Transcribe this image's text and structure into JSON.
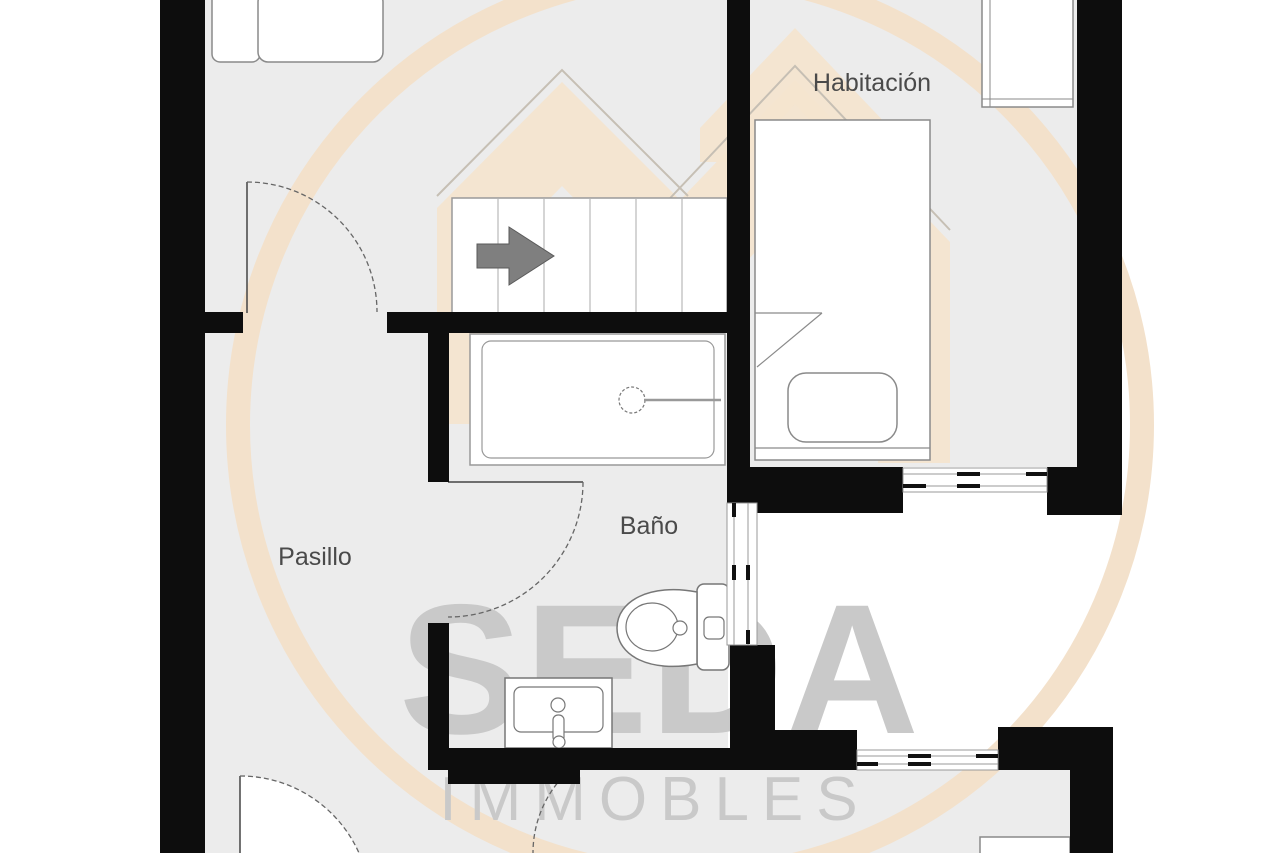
{
  "plan": {
    "type": "floorplan",
    "rooms": [
      {
        "id": "habitacion",
        "label": "Habitación"
      },
      {
        "id": "pasillo",
        "label": "Pasillo"
      },
      {
        "id": "bano",
        "label": "Baño"
      }
    ],
    "watermark": {
      "brand": "SEDA",
      "brand_sub": "IMMOBLES"
    },
    "fixtures": [
      "stairs",
      "stairs-direction-arrow",
      "bathtub",
      "toilet",
      "sink",
      "single-bed",
      "bed-cushion",
      "wardrobe",
      "cabinet",
      "bench-seats"
    ],
    "doors_count": 4,
    "sliding_windows_count": 3,
    "colors": {
      "wall": "#0d0d0d",
      "floor_grey": "#ececec",
      "room_white": "#ffffff",
      "fixture_outline": "#8a8a8a",
      "label_text": "#4a4a4a",
      "watermark_tan": "#f3e1cb",
      "watermark_grey": "#c9c9c9",
      "arrow_grey": "#7f7f7f"
    }
  }
}
